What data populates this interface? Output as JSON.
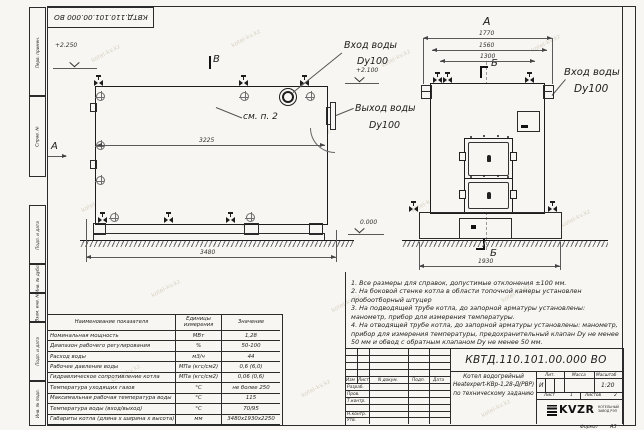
{
  "watermark": {
    "text": "kotel-kv.kz"
  },
  "doc": {
    "number": "КВТД.110.101.00.000  ВО",
    "format_label": "Формат",
    "format_value": "А3"
  },
  "margin_fields": {
    "top": [
      "Перв. примен.",
      "Справ. №"
    ],
    "bottom": [
      "Подп. и дата",
      "Инв. № дубл.",
      "Взам. инв. №",
      "Подп. и дата",
      "Инв. № подл."
    ]
  },
  "side_view": {
    "view_label": "В",
    "direction_label": "А",
    "dim_inner": "3225",
    "dim_overall": "3480",
    "note_ref": "см. п. 2",
    "elev_top": "+2.250",
    "elev_zero": "0.000"
  },
  "front_view": {
    "view_label": "А",
    "section_label": "Б",
    "dim_1770": "1770",
    "dim_1560": "1560",
    "dim_1300": "1300",
    "dim_1930": "1930",
    "elev": "+2.100"
  },
  "pipe_labels": {
    "inlet_side": {
      "line1": "Вход воды",
      "line2": "Dy100"
    },
    "outlet_side": {
      "line1": "Выход воды",
      "line2": "Dy100"
    },
    "inlet_front": {
      "line1": "Вход воды",
      "line2": "Dy100"
    }
  },
  "notes": [
    "1. Все размеры для справок, допустимые отклонения ±100 мм.",
    "2. На боковой стенке котла в области топочной камеры установлен пробоотборный штуцер",
    "3. На подводящей трубе котла, до запорной арматуры установлены: манометр, прибор для измерения температуры.",
    "4. На отводящей трубе котла, до запорной арматуры установлены: манометр, прибор для измерения температуры, предохранительный клапан Dу не менее 50 мм и обвод с обратным клапаном Dу не менее 50 мм."
  ],
  "spec_table": {
    "headers": [
      "Наименование показателя",
      "Единицы измерения",
      "Значение"
    ],
    "rows": [
      [
        "Номинальная мощность",
        "МВт",
        "1,28"
      ],
      [
        "Диапазон рабочего регулирования",
        "%",
        "50-100"
      ],
      [
        "Расход воды",
        "м3/ч",
        "44"
      ],
      [
        "Рабочее давление воды",
        "МПа (кгс/см2)",
        "0,6 (6,0)"
      ],
      [
        "Гидравлическое сопротивление котла",
        "МПа (кгс/см2)",
        "0,06 (0,6)"
      ],
      [
        "Температура уходящих газов",
        "°С",
        "не более 250"
      ],
      [
        "Максимальная рабочая температура воды",
        "°С",
        "115"
      ],
      [
        "Температура воды (вход/выход)",
        "°С",
        "70/95"
      ],
      [
        "Габариты котла (длина х ширина х высота)",
        "мм",
        "3480х1930х2250"
      ]
    ]
  },
  "title_block": {
    "header_cols": [
      "Изм",
      "Лист",
      "N докум.",
      "Подп.",
      "Дата"
    ],
    "sign_rows": [
      "Разраб.",
      "Пров.",
      "Т.контр.",
      "Н.контр.",
      "Утв."
    ],
    "product_name_1": "Котел водогрейный",
    "product_name_2": "Heatexpert-КВр-1,28-Д(РВР)",
    "product_name_3": "по техническому заданию",
    "lit_label": "Лит.",
    "mass_label": "Масса",
    "scale_label": "Масштаб",
    "lit_value": "И",
    "scale_value": "1:20",
    "sheet_label": "Лист",
    "sheet_value": "1",
    "sheets_label": "Листов",
    "sheets_value": "2",
    "company_logo": "KVZR",
    "company_sub1": "КОТЕЛЬНЫЙ",
    "company_sub2": "ЗАВОД РЭП"
  }
}
